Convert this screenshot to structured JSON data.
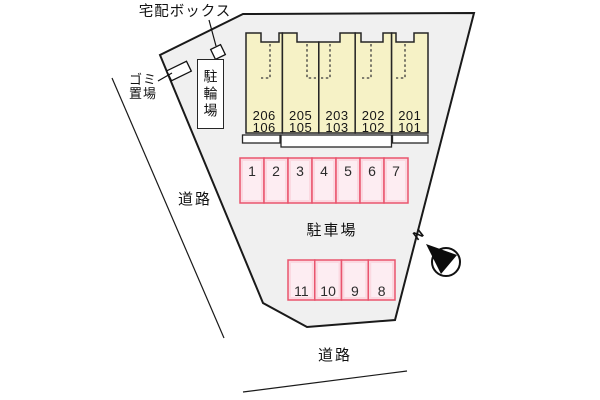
{
  "plan": {
    "labels": {
      "delivery_box": "宅配ボックス",
      "garbage_line1": "ゴミ",
      "garbage_line2": "置場",
      "bicycle_parking": "駐輪場",
      "road_left": "道路",
      "road_bottom": "道路",
      "parking_lot": "駐車場"
    },
    "building": {
      "units": [
        {
          "upper": "206",
          "lower": "106"
        },
        {
          "upper": "205",
          "lower": "105"
        },
        {
          "upper": "203",
          "lower": "103"
        },
        {
          "upper": "202",
          "lower": "102"
        },
        {
          "upper": "201",
          "lower": "101"
        }
      ]
    },
    "parking": {
      "row1": [
        "1",
        "2",
        "3",
        "4",
        "5",
        "6",
        "7"
      ],
      "row2": [
        "11",
        "10",
        "9",
        "8"
      ]
    },
    "compass": {
      "icon": "north-arrow",
      "north_label": "N"
    },
    "colors": {
      "background": "#ffffff",
      "site_fill": "#f0f0f0",
      "boundary_stroke": "#1a1a1a",
      "building_fill": "#f6f2c6",
      "building_stroke": "#262626",
      "parking_fill": "#fbd9e1",
      "parking_inner": "#fdedf2",
      "parking_stroke": "#e9556e",
      "text": "#111111"
    }
  }
}
